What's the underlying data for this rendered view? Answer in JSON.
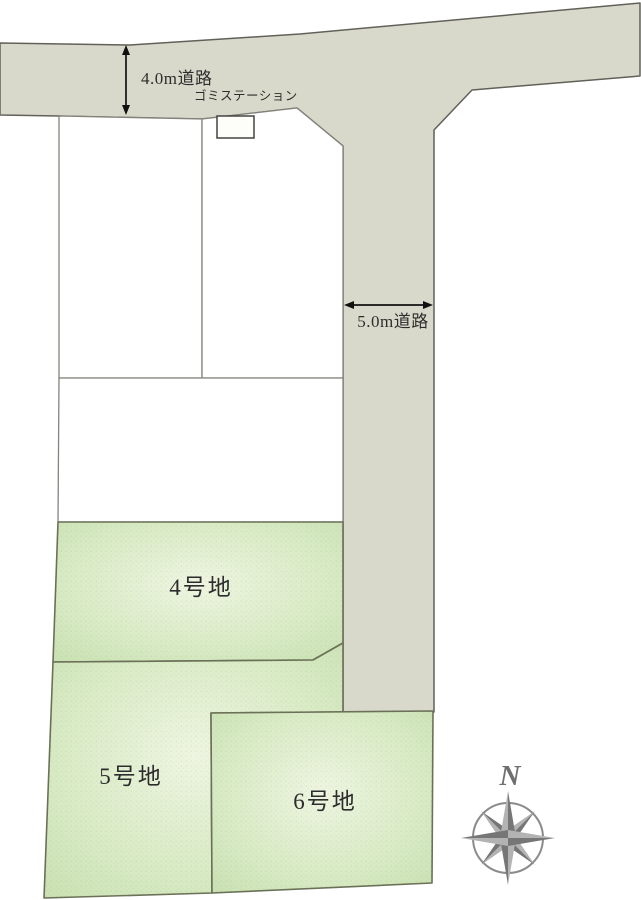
{
  "diagram": {
    "kind": "residential-lot-layout-plan",
    "roads": {
      "top": {
        "label": "4.0m道路"
      },
      "side": {
        "label": "5.0m道路"
      }
    },
    "garbage_station": {
      "label": "ゴミステーション"
    },
    "lots": {
      "lot4": {
        "label": "4号地"
      },
      "lot5": {
        "label": "5号地"
      },
      "lot6": {
        "label": "6号地"
      }
    },
    "white_lot_count": 3,
    "compass": {
      "north_label": "N"
    }
  },
  "colors": {
    "road_fill": "#d9d9cb",
    "road_border": "#61615a",
    "green_lot_center": "#eef5e1",
    "green_lot_edge": "#c6dfaf",
    "green_lot_border": "#6b7158",
    "white_lot_fill": "#ffffff",
    "white_lot_border": "#84847c",
    "dimension_arrow": "#111111",
    "label_text": "#2d2d2d",
    "compass_gray": "#8b8b8b"
  }
}
